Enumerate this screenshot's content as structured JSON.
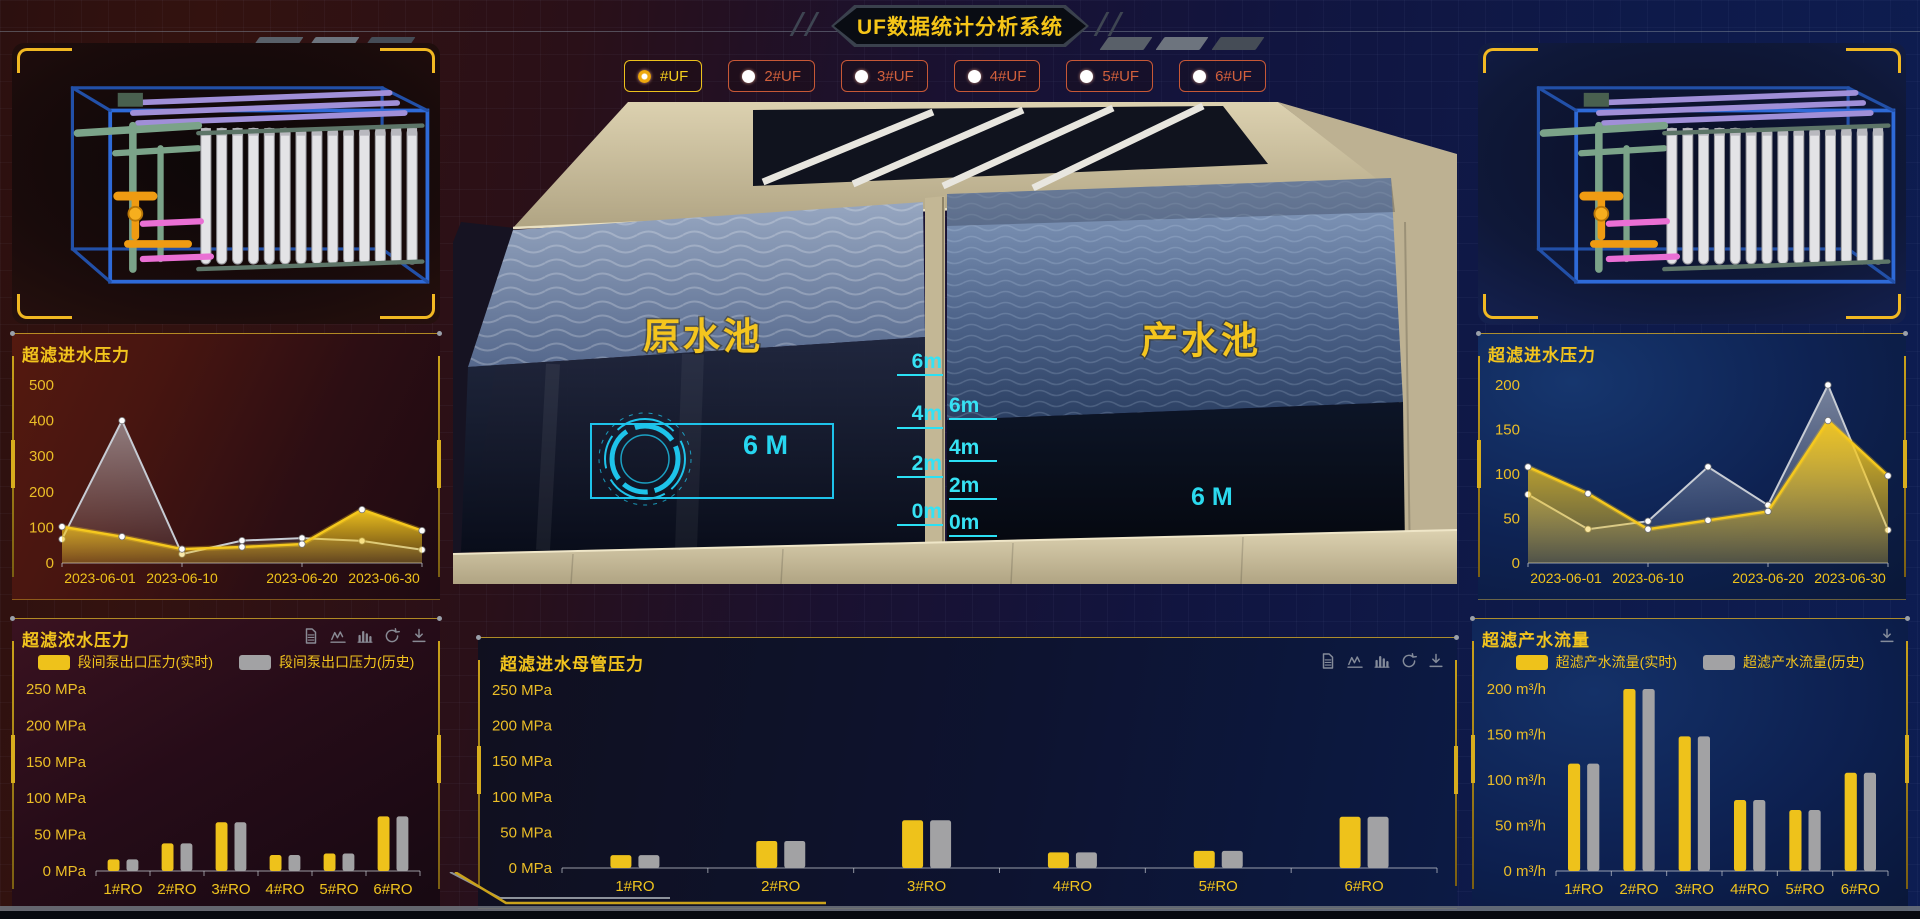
{
  "header": {
    "title": "UF数据统计分析系统"
  },
  "uf_tabs": [
    {
      "label": "#UF",
      "selected": true
    },
    {
      "label": "2#UF",
      "selected": false
    },
    {
      "label": "3#UF",
      "selected": false
    },
    {
      "label": "4#UF",
      "selected": false
    },
    {
      "label": "5#UF",
      "selected": false
    },
    {
      "label": "6#UF",
      "selected": false
    }
  ],
  "scene": {
    "left_pool_label": "原水池",
    "right_pool_label": "产水池",
    "left_level_text": "6 M",
    "right_level_text": "6 M",
    "left_scale": [
      "6m",
      "4m",
      "2m",
      "0m"
    ],
    "right_scale": [
      "6m",
      "4m",
      "2m",
      "0m"
    ]
  },
  "colors": {
    "accent_gold": "#f2c51d",
    "accent_orange": "#cf5b3a",
    "cyan": "#2bd9ee",
    "series_yellow": "#eec21b",
    "series_gray": "#a6aab2"
  },
  "chart_data": [
    {
      "id": "uf-inlet-pressure-left",
      "type": "area",
      "title": "超滤进水压力",
      "x": [
        "2023-06-01",
        "2023-06-05",
        "2023-06-10",
        "2023-06-15",
        "2023-06-20",
        "2023-06-25",
        "2023-06-30"
      ],
      "x_shown": [
        "2023-06-01",
        "2023-06-10",
        "2023-06-20",
        "2023-06-30"
      ],
      "series": [
        {
          "name": "实时",
          "color": "#f5c81e",
          "values": [
            102,
            74,
            39,
            45,
            53,
            150,
            91
          ]
        },
        {
          "name": "历史",
          "color": "#c7ccd4",
          "values": [
            67,
            400,
            25,
            63,
            70,
            62,
            37
          ]
        }
      ],
      "ylim": [
        0,
        500
      ],
      "y_step": 100,
      "unit": "",
      "legend": false,
      "toolbar": []
    },
    {
      "id": "uf-inlet-pressure-right",
      "type": "area",
      "title": "超滤进水压力",
      "x": [
        "2023-06-01",
        "2023-06-05",
        "2023-06-10",
        "2023-06-15",
        "2023-06-20",
        "2023-06-25",
        "2023-06-30"
      ],
      "x_shown": [
        "2023-06-01",
        "2023-06-10",
        "2023-06-20",
        "2023-06-30"
      ],
      "series": [
        {
          "name": "实时",
          "color": "#f5c81e",
          "values": [
            108,
            78,
            38,
            48,
            58,
            160,
            98
          ]
        },
        {
          "name": "历史",
          "color": "#c7ccd4",
          "values": [
            77,
            38,
            47,
            108,
            65,
            200,
            37
          ]
        }
      ],
      "ylim": [
        0,
        200
      ],
      "y_step": 50,
      "unit": "",
      "legend": false,
      "toolbar": []
    },
    {
      "id": "uf-concentrate-pressure",
      "type": "bar",
      "title": "超滤浓水压力",
      "categories": [
        "1#RO",
        "2#RO",
        "3#RO",
        "4#RO",
        "5#RO",
        "6#RO"
      ],
      "series": [
        {
          "name": "段间泵出口压力(实时)",
          "color": "#eec21b",
          "values": [
            16,
            38,
            67,
            22,
            24,
            75
          ]
        },
        {
          "name": "段间泵出口压力(历史)",
          "color": "#a2a2a4",
          "values": [
            16,
            38,
            67,
            22,
            24,
            75
          ]
        }
      ],
      "ylim": [
        0,
        250
      ],
      "y_step": 50,
      "unit": "MPa",
      "legend": true,
      "toolbar": [
        "file-icon",
        "line-chart-icon",
        "bar-chart-icon",
        "refresh-icon",
        "download-icon"
      ]
    },
    {
      "id": "uf-inlet-header-pressure",
      "type": "bar",
      "title": "超滤进水母管压力",
      "categories": [
        "1#RO",
        "2#RO",
        "3#RO",
        "4#RO",
        "5#RO",
        "6#RO"
      ],
      "series": [
        {
          "name": "",
          "color": "#eec21b",
          "values": [
            18,
            38,
            67,
            22,
            24,
            72
          ]
        },
        {
          "name": "",
          "color": "#a2a2a4",
          "values": [
            18,
            38,
            67,
            22,
            24,
            72
          ]
        }
      ],
      "ylim": [
        0,
        250
      ],
      "y_step": 50,
      "unit": "MPa",
      "legend": false,
      "toolbar": [
        "file-icon",
        "line-chart-icon",
        "bar-chart-icon",
        "refresh-icon",
        "download-icon"
      ]
    },
    {
      "id": "uf-product-flow",
      "type": "bar",
      "title": "超滤产水流量",
      "categories": [
        "1#RO",
        "2#RO",
        "3#RO",
        "4#RO",
        "5#RO",
        "6#RO"
      ],
      "series": [
        {
          "name": "超滤产水流量(实时)",
          "color": "#eec21b",
          "values": [
            118,
            200,
            148,
            78,
            67,
            108
          ]
        },
        {
          "name": "超滤产水流量(历史)",
          "color": "#a2a2a4",
          "values": [
            118,
            200,
            148,
            78,
            67,
            108
          ]
        }
      ],
      "ylim": [
        0,
        200
      ],
      "y_step": 50,
      "unit": "m³/h",
      "legend": true,
      "toolbar": [
        "download-icon"
      ]
    }
  ]
}
